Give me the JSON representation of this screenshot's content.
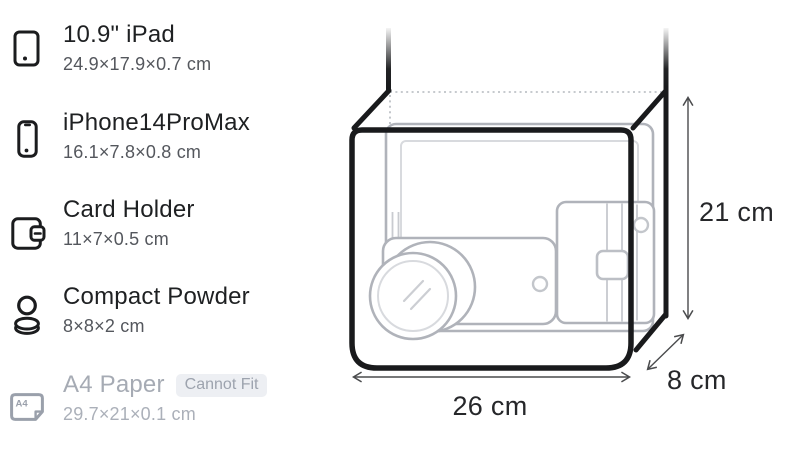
{
  "items": [
    {
      "name": "10.9\" iPad",
      "dimensions": "24.9×17.9×0.7 cm",
      "icon": "tablet-icon",
      "fits": true
    },
    {
      "name": "iPhone14ProMax",
      "dimensions": "16.1×7.8×0.8 cm",
      "icon": "smartphone-icon",
      "fits": true
    },
    {
      "name": "Card Holder",
      "dimensions": "11×7×0.5 cm",
      "icon": "wallet-icon",
      "fits": true
    },
    {
      "name": "Compact Powder",
      "dimensions": "8×8×2 cm",
      "icon": "compact-powder-icon",
      "fits": true
    },
    {
      "name": "A4 Paper",
      "dimensions": "29.7×21×0.1 cm",
      "icon": "a4-paper-icon",
      "fits": false,
      "badge": "Cannot Fit",
      "icon_label": "A4"
    }
  ],
  "diagram": {
    "type": "bag-dimension-illustration",
    "width_label": "26 cm",
    "height_label": "21 cm",
    "depth_label": "8 cm",
    "contents_shown": [
      "10.9\" iPad",
      "iPhone14ProMax",
      "Card Holder",
      "Compact Powder"
    ]
  },
  "colors": {
    "background": "#ffffff",
    "text_primary": "#1e2022",
    "text_secondary": "#54575d",
    "disabled_text": "#a6abb4",
    "badge_background": "#edeff3",
    "badge_text": "#9da3ae",
    "bag_outline": "#191a1c",
    "item_outline": "#b6b9bf",
    "arrow": "#4a4b4d"
  }
}
